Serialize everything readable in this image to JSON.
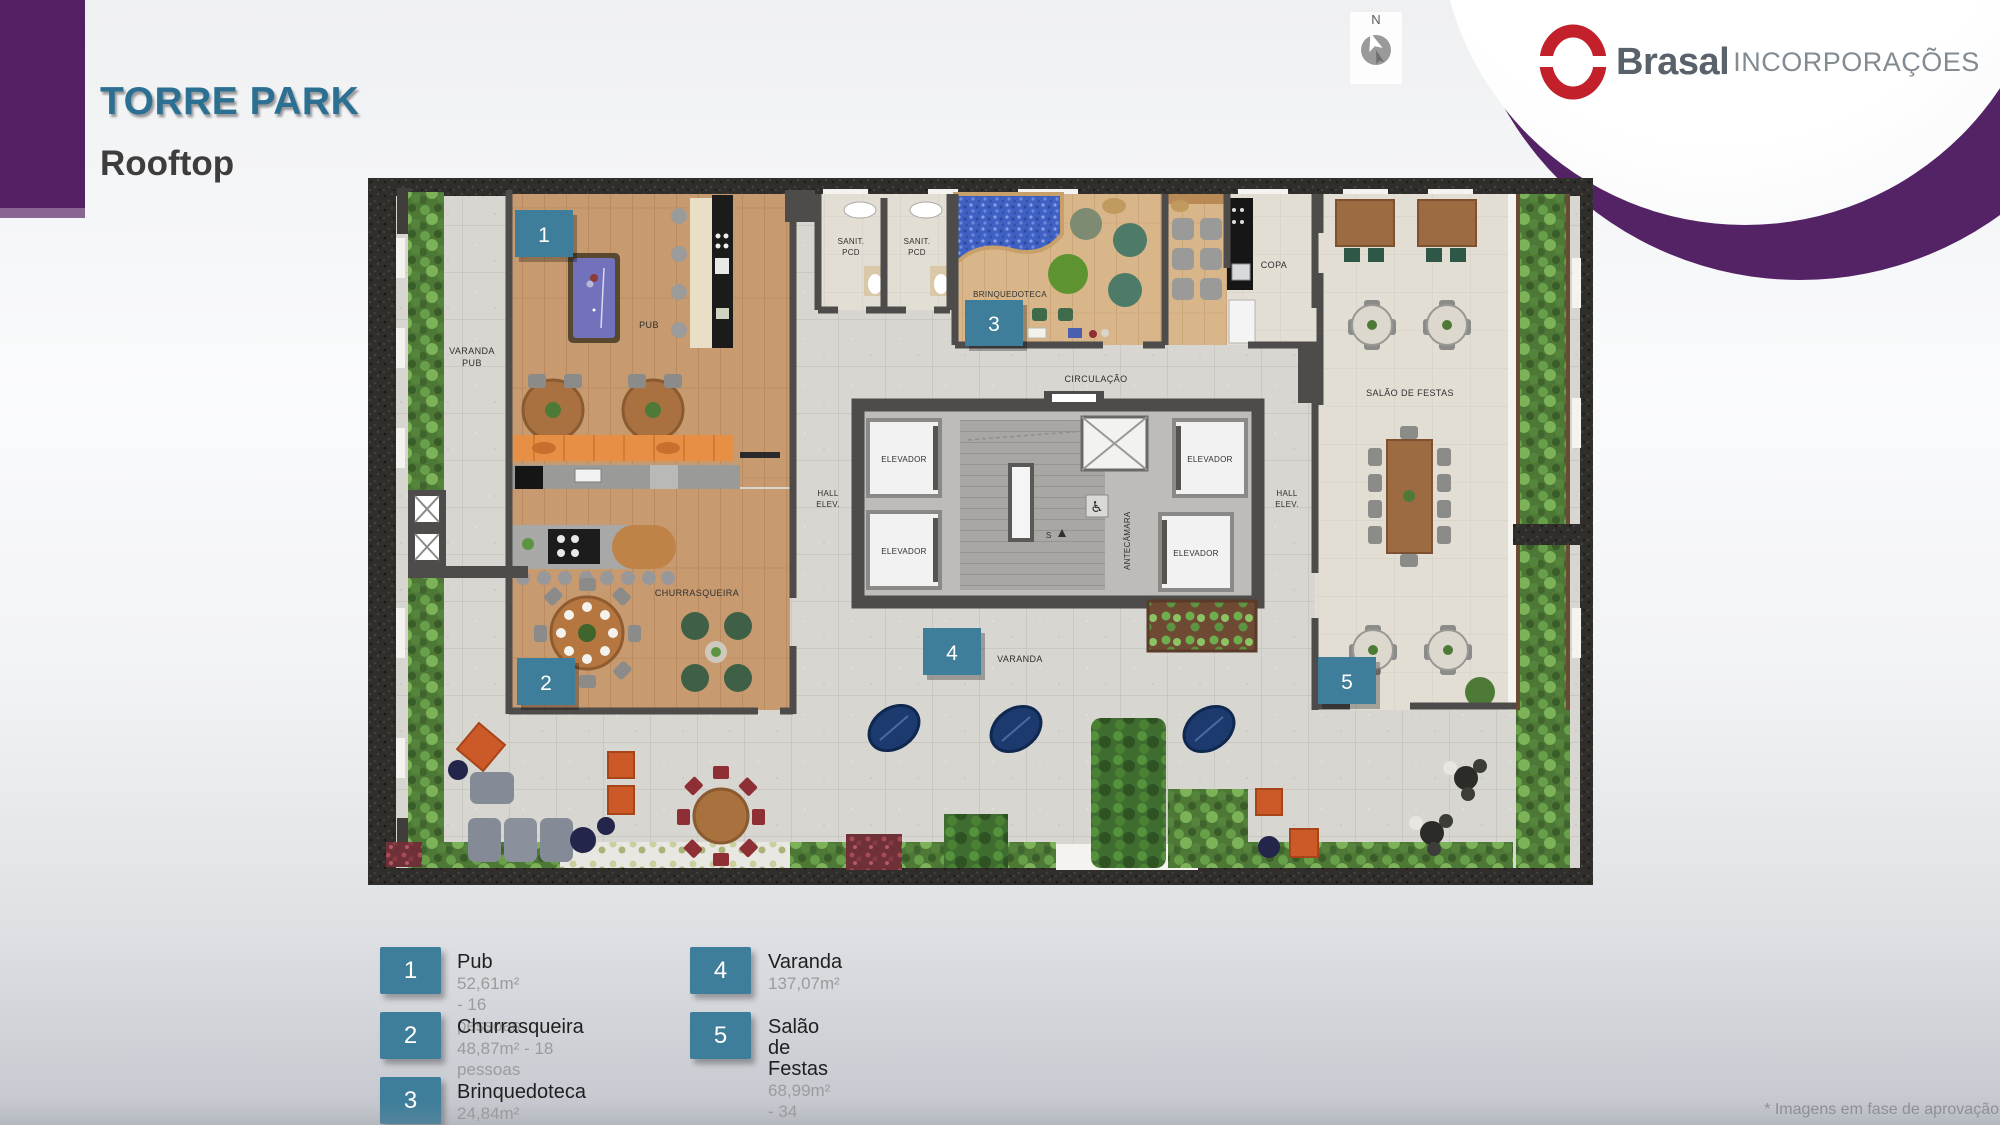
{
  "header": {
    "title": "TORRE PARK",
    "subtitle": "Rooftop"
  },
  "logo": {
    "name": "Brasal",
    "suffix": "INCORPORAÇÕES"
  },
  "compass": {
    "label": "N"
  },
  "plan": {
    "badges": {
      "b1": "1",
      "b2": "2",
      "b3": "3",
      "b4": "4",
      "b5": "5"
    },
    "labels": {
      "varanda_pub": [
        "VARANDA",
        "PUB"
      ],
      "pub": "PUB",
      "sanit": [
        "SANIT.",
        "PCD"
      ],
      "brinquedoteca": "BRINQUEDOTECA",
      "copa": "COPA",
      "circulacao": "CIRCULAÇÃO",
      "salao": "SALÃO DE FESTAS",
      "hall": [
        "HALL",
        "ELEV."
      ],
      "elevador": "ELEVADOR",
      "antecamara": "ANTECÂMARA",
      "stairs": "S",
      "churrasqueira": "CHURRASQUEIRA",
      "varanda": "VARANDA"
    }
  },
  "legend": {
    "items": [
      {
        "number": "1",
        "title": "Pub",
        "details": "52,61m² - 16 pessoas"
      },
      {
        "number": "2",
        "title": "Churrasqueira",
        "details": "48,87m² - 18 pessoas"
      },
      {
        "number": "3",
        "title": "Brinquedoteca",
        "details": "24,84m²"
      },
      {
        "number": "4",
        "title": "Varanda",
        "details": "137,07m²"
      },
      {
        "number": "5",
        "title": "Salão de Festas",
        "details": "68,99m² - 34 pessoas"
      }
    ]
  },
  "disclaimer": "* Imagens em fase de aprovação",
  "colors": {
    "accent_teal": "#3f7e9a",
    "brand_purple": "#522063",
    "title_blue": "#2b7093",
    "logo_red": "#c2202a"
  }
}
